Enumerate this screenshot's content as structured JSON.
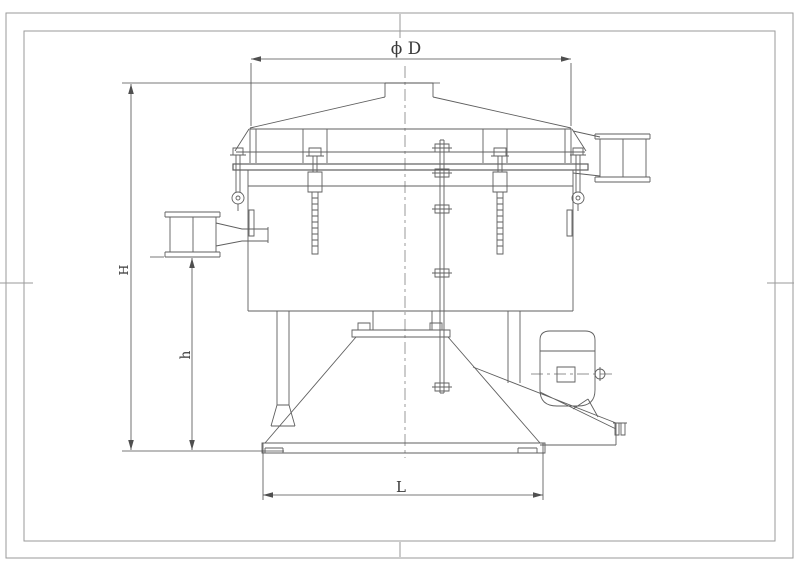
{
  "labels": {
    "diameter": "ϕ D",
    "height_total": "H",
    "height_outlet": "h",
    "base_width": "L"
  },
  "colors": {
    "line": "#5f5f5f",
    "thin": "#6e6e6e",
    "dim": "#4f4f4f",
    "frame": "#9a9a9a",
    "text": "#3a3a3a",
    "background": "#ffffff"
  }
}
